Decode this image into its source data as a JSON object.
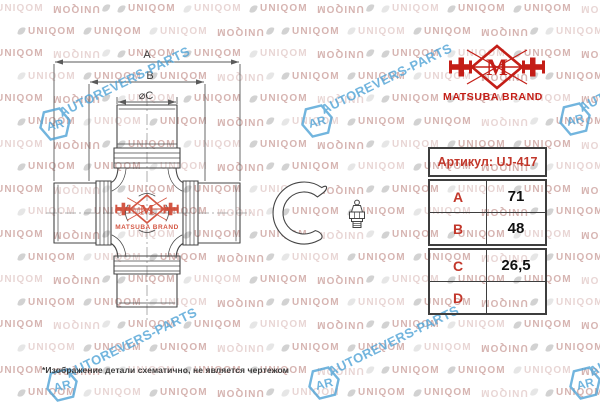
{
  "brand": {
    "logo_text": "M",
    "name": "MATSUBA BRAND",
    "color": "#c41e17"
  },
  "table": {
    "header": "Артикул: UJ-417",
    "rows": [
      {
        "param": "A",
        "value": "71"
      },
      {
        "param": "B",
        "value": "48"
      },
      {
        "param": "C",
        "value": "26,5"
      },
      {
        "param": "D",
        "value": ""
      }
    ]
  },
  "drawing": {
    "dim_labels": {
      "a": "A",
      "b": "B",
      "c": "⌀C"
    }
  },
  "watermark": {
    "tile": "UNIQOM",
    "diagonal": "AUTOREVERS-PARTS",
    "badge": "AR",
    "tile_color": "#d6b4b1",
    "accent": "#4fa3d6"
  },
  "footnote": "*Изображение детали схематично, не является чертежом"
}
